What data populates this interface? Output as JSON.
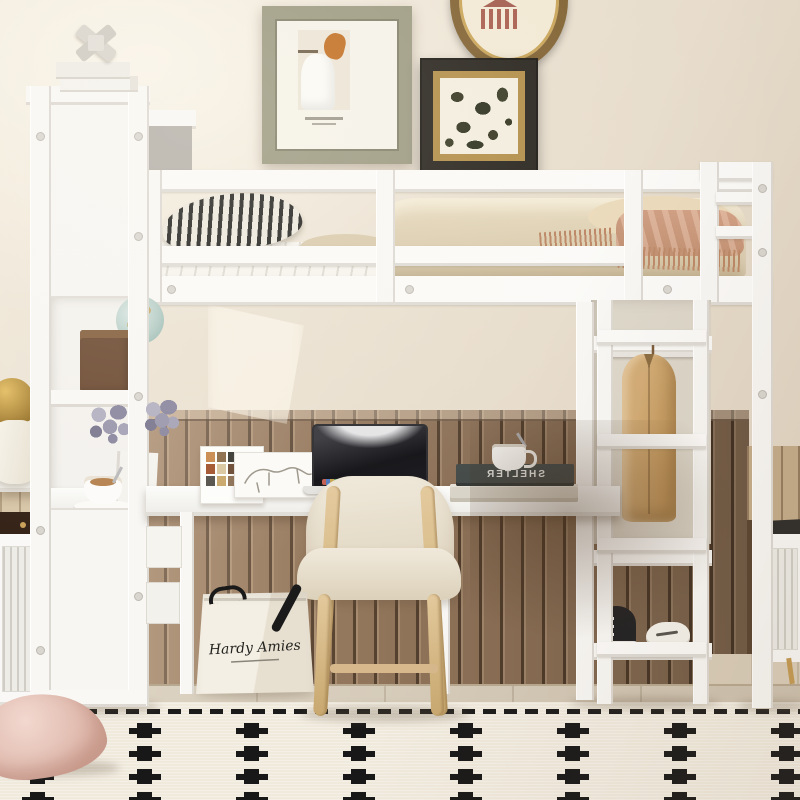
{
  "scene": {
    "description": "White metal loft bed with built-in desk, bookshelf tower, wardrobe rail and ladder, styled with beige bedding, wall art and a black-motif cream rug",
    "palette": {
      "wall": "#ebe2d2",
      "wood_paneling": "#8f7257",
      "furniture_white": "#f8f7f5",
      "bedding_tan": "#d9c9ab",
      "throw_peach": "#cb9a7c",
      "chair_wood": "#d9bd92",
      "rug_cream": "#f0eadd",
      "rug_motif_black": "#181818",
      "frame_sage": "#9a987f",
      "frame_gold": "#b08b44",
      "jacket_tan": "#c9a26b"
    }
  },
  "shopping_bag": {
    "brand_script": "Hardy Amies"
  },
  "desk_books": {
    "top_spine_mirrored": "SHELTER"
  },
  "rug": {
    "rows": 4,
    "cols": 8,
    "row_start": 20,
    "row_step": 23,
    "col_start": 22,
    "col_step": 107
  }
}
